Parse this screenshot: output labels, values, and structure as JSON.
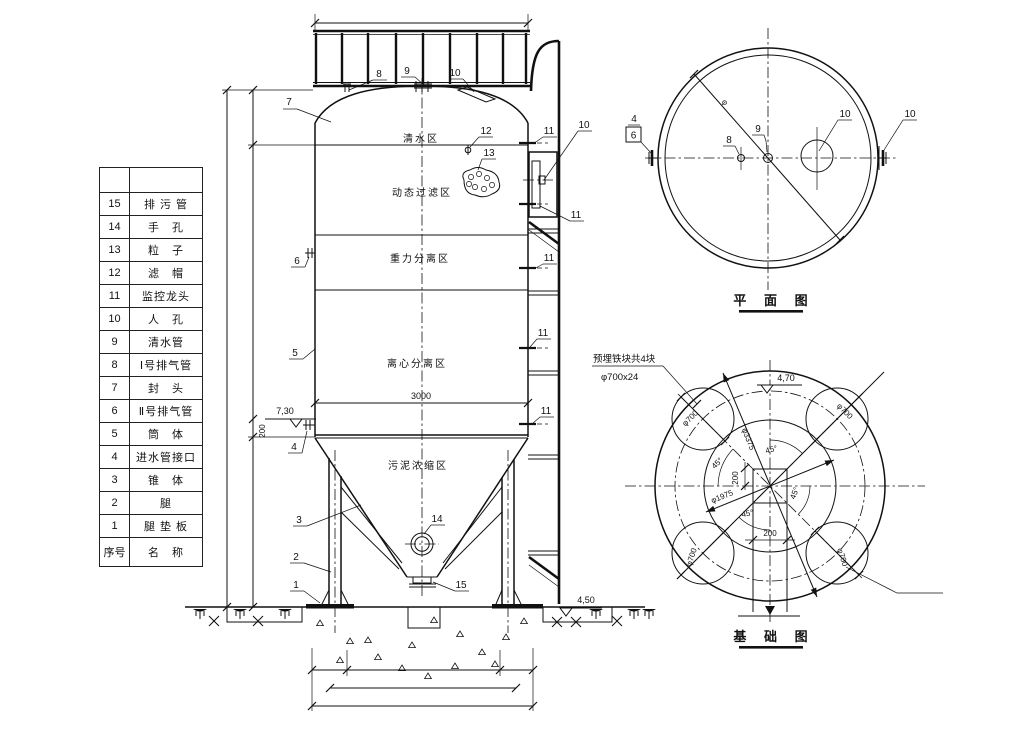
{
  "parts_table": {
    "header_no": "序号",
    "header_name": "名　称",
    "rows": [
      {
        "no": "15",
        "name": "排 污 管"
      },
      {
        "no": "14",
        "name": "手　孔"
      },
      {
        "no": "13",
        "name": "粒　子"
      },
      {
        "no": "12",
        "name": "滤　帽"
      },
      {
        "no": "11",
        "name": "监控龙头"
      },
      {
        "no": "10",
        "name": "人　孔"
      },
      {
        "no": "9",
        "name": "清水管"
      },
      {
        "no": "8",
        "name": "Ⅰ号排气管"
      },
      {
        "no": "7",
        "name": "封　头"
      },
      {
        "no": "6",
        "name": "Ⅱ号排气管"
      },
      {
        "no": "5",
        "name": "筒　体"
      },
      {
        "no": "4",
        "name": "进水管接口"
      },
      {
        "no": "3",
        "name": "锥　体"
      },
      {
        "no": "2",
        "name": "腿"
      },
      {
        "no": "1",
        "name": "腿 垫 板"
      }
    ]
  },
  "callouts": {
    "n1": "1",
    "n2": "2",
    "n3": "3",
    "n4": "4",
    "n5": "5",
    "n6": "6",
    "n7": "7",
    "n8": "8",
    "n9": "9",
    "n10": "10",
    "n11": "11",
    "n12": "12",
    "n13": "13",
    "n14": "14",
    "n15": "15"
  },
  "elevation": {
    "zones": [
      "清水区",
      "动态过滤区",
      "重力分离区",
      "离心分离区",
      "污泥浓缩区"
    ],
    "dims": {
      "width": "3000",
      "h200": "200",
      "level_730": "7,30",
      "level_450": "4,50"
    }
  },
  "plan": {
    "title": "平 面 图",
    "dims": {
      "phi": "φ"
    }
  },
  "foundation": {
    "title": "基 础 图",
    "note1": "预埋铁块共4块",
    "note2": "φ700x24",
    "dims": {
      "d3375": "φ3375",
      "d1975": "φ1975",
      "d700": "φ700",
      "a45": "45°",
      "d200": "200",
      "level_470": "4,70"
    }
  }
}
